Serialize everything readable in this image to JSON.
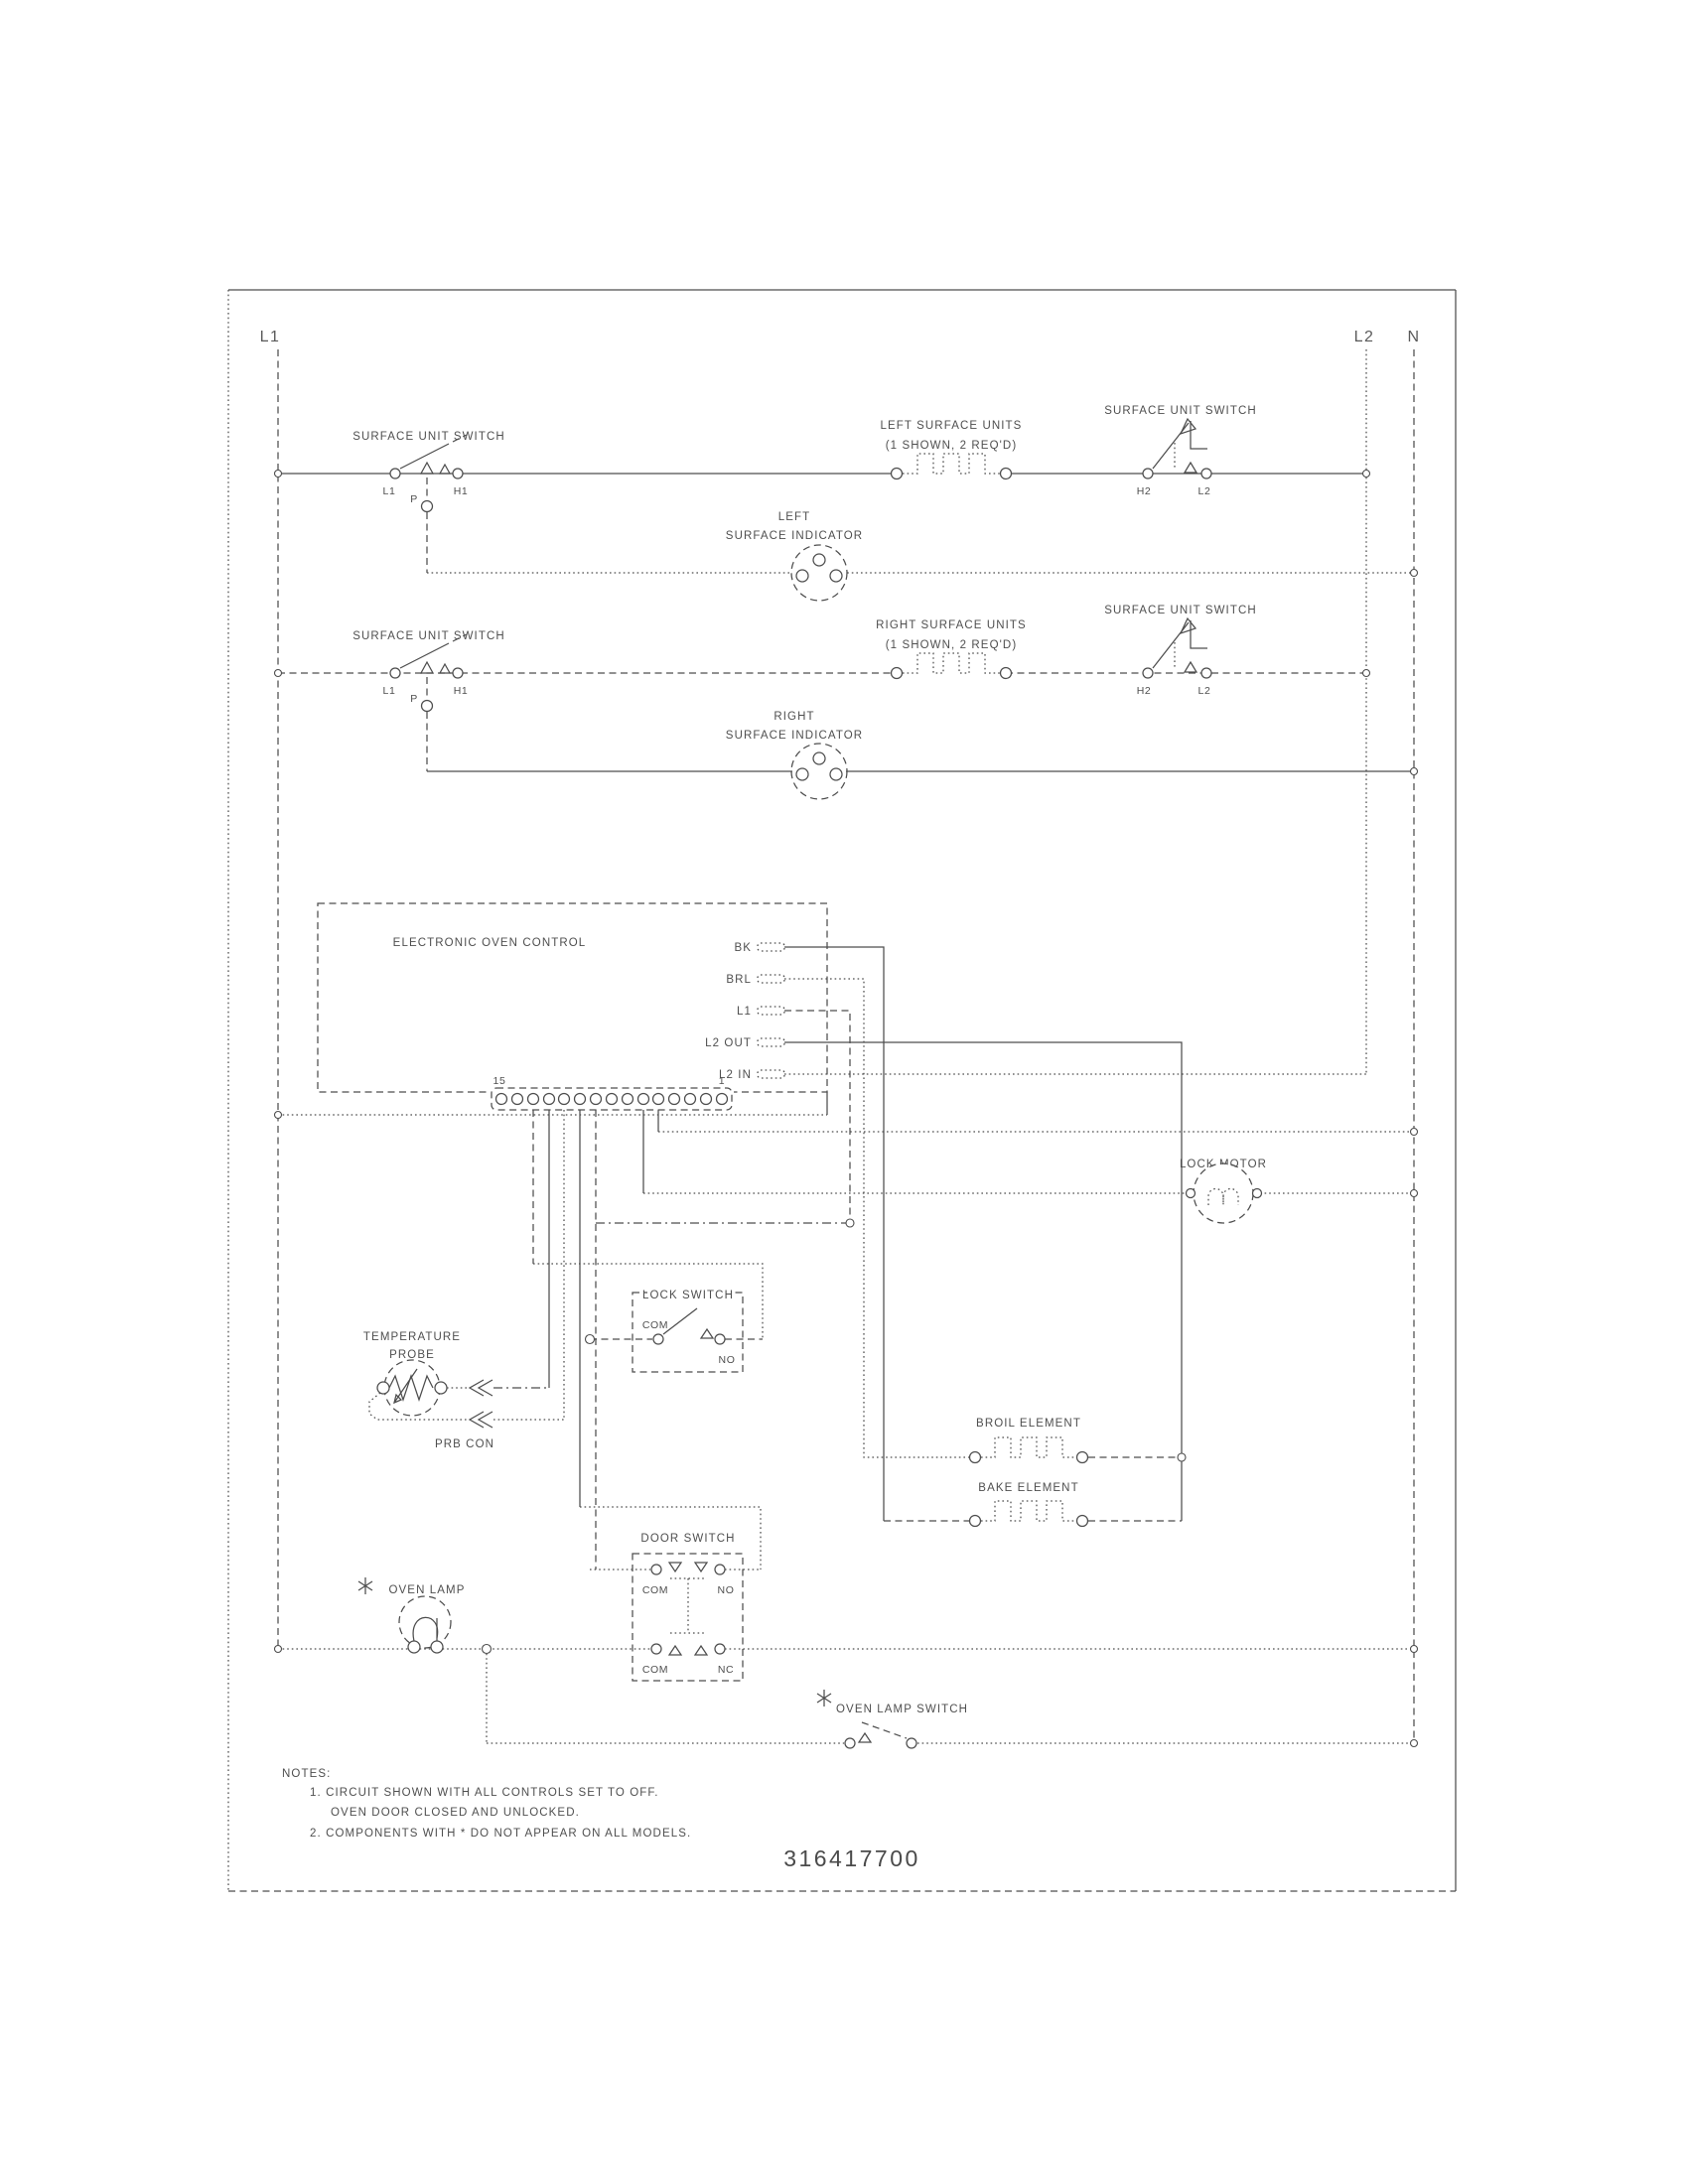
{
  "title_block": {
    "part_number": "316417700"
  },
  "buses": {
    "l1": "L1",
    "l2": "L2",
    "n": "N"
  },
  "shared": {
    "surface_unit_switch": "SURFACE UNIT SWITCH",
    "units_sub": "(1 SHOWN, 2 REQ'D)",
    "surface_indicator": "SURFACE INDICATOR",
    "t_l1": "L1",
    "t_p": "P",
    "t_h1": "H1",
    "t_h2": "H2",
    "t_l2": "L2",
    "com": "COM",
    "no": "NO",
    "nc": "NC"
  },
  "row1": {
    "units": "LEFT SURFACE UNITS",
    "indicator": "LEFT"
  },
  "row2": {
    "units": "RIGHT SURFACE UNITS",
    "indicator": "RIGHT"
  },
  "eoc": {
    "title": "ELECTRONIC OVEN CONTROL",
    "bk": "BK",
    "brl": "BRL",
    "l1": "L1",
    "l2_out": "L2 OUT",
    "l2_in": "L2 IN",
    "pin_15": "15",
    "pin_1": "1"
  },
  "lock_motor": {
    "label": "LOCK MOTOR"
  },
  "lock_switch": {
    "label": "LOCK SWITCH"
  },
  "temperature_probe": {
    "line1": "TEMPERATURE",
    "line2": "PROBE",
    "connector": "PRB CON"
  },
  "elements": {
    "broil": "BROIL ELEMENT",
    "bake": "BAKE ELEMENT"
  },
  "door_switch": {
    "label": "DOOR SWITCH"
  },
  "oven_lamp": {
    "label": "OVEN LAMP"
  },
  "oven_lamp_switch": {
    "label": "OVEN LAMP SWITCH"
  },
  "notes": {
    "heading": "NOTES:",
    "note1a": "1.  CIRCUIT SHOWN WITH ALL CONTROLS SET TO OFF.",
    "note1b": "OVEN DOOR CLOSED AND UNLOCKED.",
    "note2": "2.  COMPONENTS WITH  *  DO NOT APPEAR ON ALL MODELS."
  }
}
